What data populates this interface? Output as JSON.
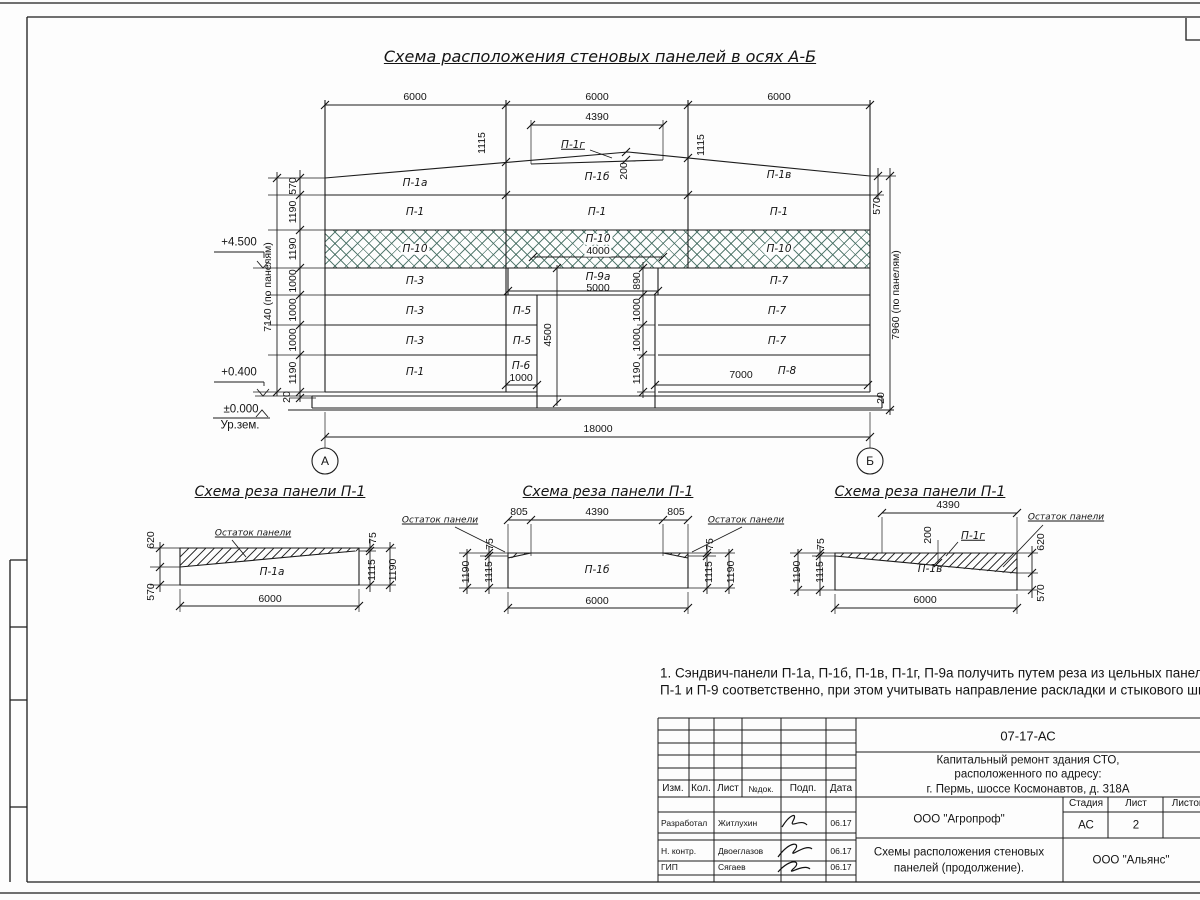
{
  "main": {
    "title": "Схема расположения стеновых панелей в осях А-Б",
    "dims": {
      "bay": "6000",
      "ridge_w": "4390",
      "h1115": "1115",
      "ridge_t": "200",
      "p10w": "4000",
      "p9aw": "5000",
      "doorh": "4500",
      "p6w": "1000",
      "p8w": "7000",
      "total": "18000",
      "left_chain": [
        "570",
        "1190",
        "1190",
        "1000",
        "1000",
        "1000",
        "1190",
        "20"
      ],
      "left_total": "7140 (по панелям)",
      "right_570": "570",
      "right_total": "7960 (по панелям)",
      "d20": "20",
      "door_chain": [
        "890",
        "1000",
        "1000",
        "1190"
      ]
    },
    "panels": {
      "r1": [
        "П-1а",
        "П-1б",
        "П-1в"
      ],
      "ridge": "П-1г",
      "r2": [
        "П-1",
        "П-1",
        "П-1"
      ],
      "r3": [
        "П-10",
        "П-10",
        "П-10"
      ],
      "r4": [
        "П-3",
        "П-9а",
        "П-7"
      ],
      "r5": [
        "П-3",
        "П-5",
        "П-7"
      ],
      "r6": [
        "П-3",
        "П-5",
        "П-7"
      ],
      "r7": [
        "П-1",
        "П-6",
        "П-8"
      ]
    },
    "levels": {
      "v1": "+4.500",
      "v2": "+0.400",
      "v3": "±0.000",
      "ground": "Ур.зем."
    },
    "axes": {
      "a": "А",
      "b": "Б"
    }
  },
  "schemes": [
    {
      "title": "Схема реза панели П-1",
      "remnant": "Остаток панели",
      "panel": "П-1а",
      "d620": "620",
      "d570": "570",
      "d75": "75",
      "d1115": "1115",
      "d1190": "1190",
      "d6000": "6000"
    },
    {
      "title": "Схема реза панели П-1",
      "remnant": "Остаток панели",
      "panel": "П-1б",
      "d805": "805",
      "d4390": "4390",
      "d75": "75",
      "d1115": "1115",
      "d1190": "1190",
      "d6000": "6000"
    },
    {
      "title": "Схема реза панели П-1",
      "remnant": "Остаток панели",
      "panel": "П-1в",
      "ridge": "П-1г",
      "d4390": "4390",
      "d200": "200",
      "d75": "75",
      "d1115": "1115",
      "d1190": "1190",
      "d620": "620",
      "d570": "570",
      "d6000": "6000"
    }
  ],
  "note": {
    "line1": "1. Сэндвич-панели П-1а, П-1б, П-1в, П-1г, П-9а получить путем реза из цельных панелей",
    "line2": "П-1 и П-9 соответственно, при этом учитывать направление раскладки и стыкового шва."
  },
  "title_block": {
    "doc_number": "07-17-АС",
    "project_line1": "Капитальный ремонт здания СТО,",
    "project_line2": "расположенного по адресу:",
    "project_line3": "г. Пермь, шоссе Космонавтов, д. 318А",
    "cols": {
      "izm": "Изм.",
      "kol": "Кол.",
      "list": "Лист",
      "ndok": "№док.",
      "podp": "Подп.",
      "data": "Дата"
    },
    "stage_header": {
      "stage": "Стадия",
      "sheet": "Лист",
      "sheets": "Листов"
    },
    "stage_value": "АС",
    "sheet_value": "2",
    "org_designer": "ООО \"Агропроф\"",
    "org_client": "ООО \"Альянс\"",
    "drawing_title_line1": "Схемы расположения стеновых",
    "drawing_title_line2": "панелей (продолжение).",
    "rows": [
      {
        "role": "Разработал",
        "name": "Житлухин",
        "date": "06.17"
      },
      {
        "role": "Н. контр.",
        "name": "Двоеглазов",
        "date": "06.17"
      },
      {
        "role": "ГИП",
        "name": "Сягаев",
        "date": "06.17"
      }
    ]
  },
  "colors": {
    "hatch_green": "#3e685c",
    "line": "#1c1c1c"
  }
}
